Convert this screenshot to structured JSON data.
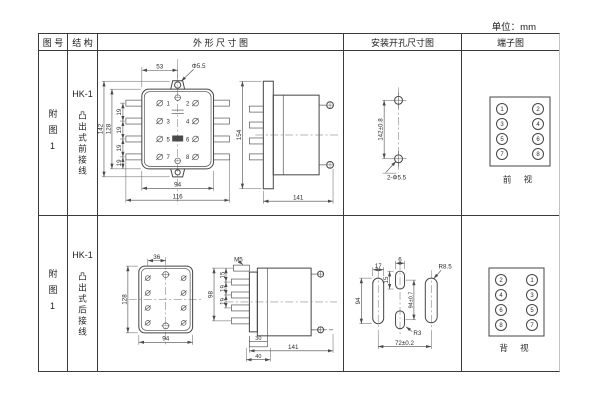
{
  "unit_label": "单位：mm",
  "headers": {
    "fig_no": "图 号",
    "structure": "结 构",
    "outline": "外 形 尺 寸 图",
    "mounting": "安装开孔尺寸图",
    "terminal": "端子图"
  },
  "rows": [
    {
      "fig_no": "附图1",
      "model": "HK-1",
      "structure": "凸出式前接线",
      "outline": {
        "top_width": "53",
        "top_hole": "Φ5.5",
        "outer_height": "142",
        "inner_height": "128",
        "pitch": [
          "19",
          "19",
          "19",
          "19"
        ],
        "inner_width": "94",
        "outer_width": "116",
        "terminals": [
          "1",
          "2",
          "3",
          "4",
          "5",
          "6",
          "7",
          "8"
        ],
        "side_height": "154",
        "side_depth": "141"
      },
      "mounting": {
        "hole_spacing": "142±0.8",
        "holes_label": "2-Φ5.5"
      },
      "terminal_diagram": {
        "cells": [
          "1",
          "2",
          "3",
          "4",
          "5",
          "6",
          "7",
          "8"
        ],
        "view_label": "前 视"
      }
    },
    {
      "fig_no": "附图1",
      "model": "HK-1",
      "structure": "凸出式后接线",
      "outline": {
        "top_offset": "36",
        "height": "128",
        "width": "94",
        "thread": "M5",
        "stud_span": "98",
        "stud_pitch": [
          "15",
          "19",
          "19"
        ],
        "cover_inner": "30",
        "cover_outer": "40",
        "side_depth": "141"
      },
      "mounting": {
        "slot_width": "17",
        "slot_height": "94",
        "hole_width": "6",
        "hole_height": "15",
        "hole_spacing": "94±0.7",
        "corner_radius": "R8.5",
        "small_radius": "R3",
        "horizontal_spacing": "72±0.2"
      },
      "terminal_diagram": {
        "cells": [
          "2",
          "1",
          "4",
          "3",
          "6",
          "5",
          "8",
          "7"
        ],
        "view_label": "背 视"
      }
    }
  ]
}
